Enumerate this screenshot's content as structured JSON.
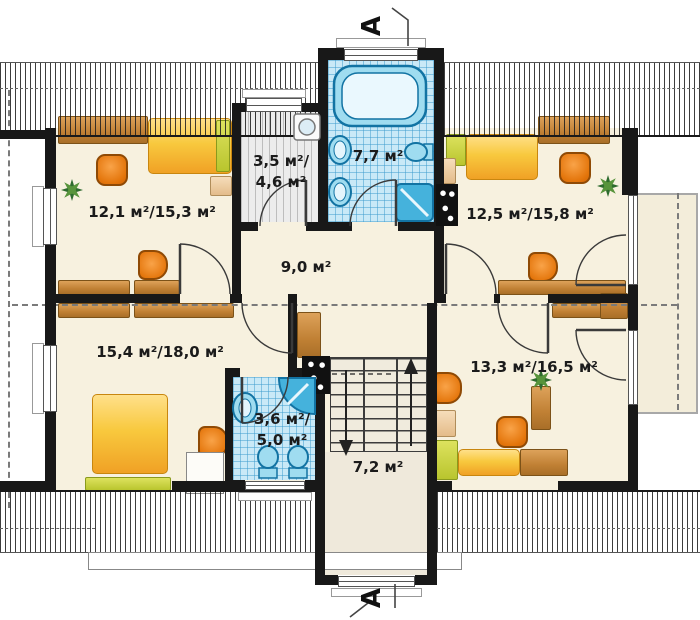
{
  "title": "Attic floor plan",
  "section_markers": {
    "top": "A",
    "bottom": "A"
  },
  "rooms": {
    "bedroom_top_left": "12,1 м²/15,3 м²",
    "wardrobe_line1": "3,5 м²/",
    "wardrobe_line2": "4,6 м²",
    "bathroom_top": "7,7 м²",
    "bedroom_top_right": "12,5 м²/15,8 м²",
    "hall": "9,0 м²",
    "bedroom_bottom_left": "15,4 м²/18,0 м²",
    "bathroom_bottom_line1": "3,6 м²/",
    "bathroom_bottom_line2": "5,0 м²",
    "staircase": "7,2 м²",
    "bedroom_bottom_right": "13,3 м²/16,5 м²"
  },
  "colors": {
    "floor": "#f7f1df",
    "wall": "#181818",
    "bathroom_tile": "#c9e9f7",
    "wood": "#c08034",
    "furniture_yellow": "#f8c93e",
    "furniture_orange": "#e4760c",
    "accent_green": "#b9c52e",
    "fixture_blue": "#45b2dc"
  }
}
